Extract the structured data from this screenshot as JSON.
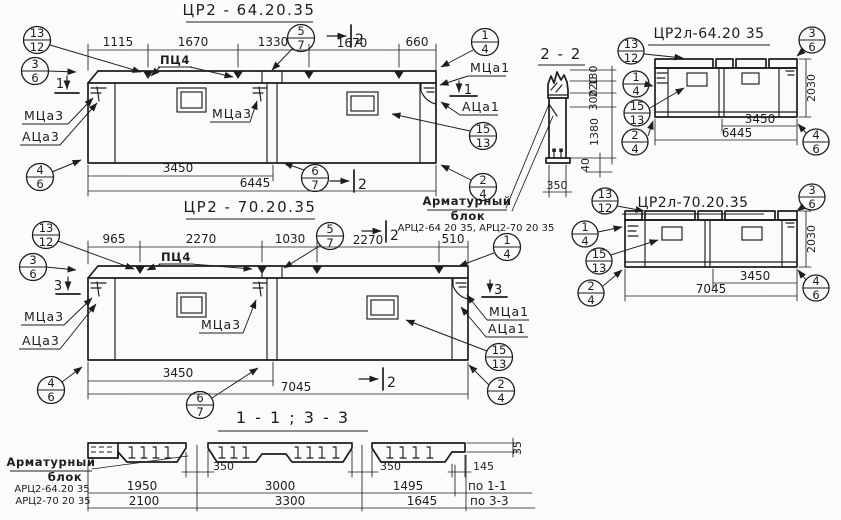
{
  "titles": {
    "view1": "ЦР2 - 64.20.35",
    "view2": "ЦР2 - 70.20.35",
    "section22": "2 - 2",
    "view3": "ЦР2л-64.20 35",
    "view4": "ЦР2л-70.20.35",
    "section1133": "1 - 1  ;  3 - 3"
  },
  "markers": {
    "m13_12": {
      "top": "13",
      "bot": "12"
    },
    "m3_6": {
      "top": "3",
      "bot": "6"
    },
    "m4_6": {
      "top": "4",
      "bot": "6"
    },
    "m5_7": {
      "top": "5",
      "bot": "7"
    },
    "m6_7": {
      "top": "6",
      "bot": "7"
    },
    "m1_4": {
      "top": "1",
      "bot": "4"
    },
    "m15_13": {
      "top": "15",
      "bot": "13"
    },
    "m2_4": {
      "top": "2",
      "bot": "4"
    }
  },
  "view1": {
    "dims_top": [
      "1115",
      "1670",
      "1330",
      "1670",
      "660"
    ],
    "dim_mid": "3450",
    "dim_total": "6445",
    "label_pc": "ПЦ4",
    "label_mc3_left": "МЦа3",
    "label_ac3_left": "АЦа3",
    "label_mc3_mid": "МЦа3",
    "label_mc1": "МЦа1",
    "label_ac1": "АЦа1",
    "cut1": "1",
    "cut2": "2"
  },
  "view2": {
    "dims_top": [
      "965",
      "2270",
      "1030",
      "2270",
      "510"
    ],
    "dim_mid": "3450",
    "dim_total": "7045",
    "label_pc": "ПЦ4",
    "label_mc3_left": "МЦа3",
    "label_ac3_left": "АЦа3",
    "label_mc3_mid": "МЦа3",
    "label_mc1": "МЦа1",
    "label_ac1": "АЦа1",
    "cut2": "2",
    "cut3": "3"
  },
  "section22": {
    "v_dims": [
      "130",
      "220",
      "300",
      "1380"
    ],
    "dim_40": "40",
    "dim_350": "350"
  },
  "note_mid": {
    "l1": "Арматурный",
    "l2": "блок",
    "l3": "АРЦ2-64 20 35, АРЦ2-70 20 35"
  },
  "view3": {
    "dim_mid": "3450",
    "dim_total": "6445",
    "dim_h": "2030"
  },
  "view4": {
    "dim_mid": "3450",
    "dim_total": "7045",
    "dim_h": "2030"
  },
  "section1133": {
    "gap1": "350",
    "gap2": "350",
    "dim_145": "145",
    "dim_35": "35",
    "row1": [
      "1950",
      "3000",
      "1495"
    ],
    "row1_label": "по 1-1",
    "row2": [
      "2100",
      "3300",
      "1645"
    ],
    "row2_label": "по 3-3"
  },
  "note_bottom": {
    "l1": "Арматурный",
    "l2": "блок",
    "l3": "АРЦ2-64.20 35",
    "l4": "АРЦ2-70 20 35"
  }
}
